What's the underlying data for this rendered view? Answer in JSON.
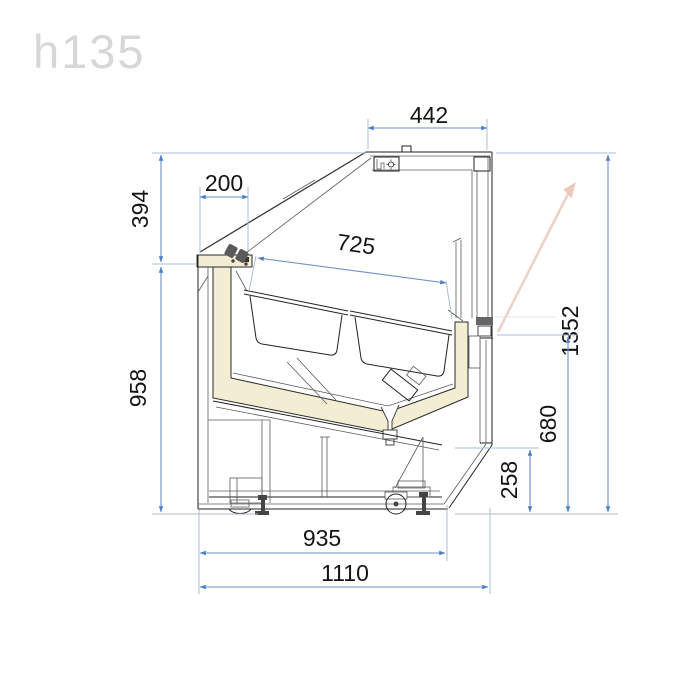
{
  "watermark": {
    "text": "h135"
  },
  "diagram": {
    "type": "technical-drawing",
    "subject": "refrigerated serve-over display counter, side cross-section",
    "units": "mm",
    "colors": {
      "dimension_line": "#6b8fc7",
      "dimension_arrow": "#4b7ec2",
      "extension_line": "#a9bcd8",
      "drawing_line": "#222222",
      "insulation_fill": "#f3edd3",
      "airflow_arrow": "#e9cabb",
      "watermark": "#d7d7d7",
      "text": "#141414"
    },
    "dimensions": [
      {
        "id": "canopy_depth",
        "value": "442",
        "orientation": "horizontal",
        "location": "top"
      },
      {
        "id": "front_overhang",
        "value": "200",
        "orientation": "horizontal",
        "location": "upper-left"
      },
      {
        "id": "glass_height",
        "value": "394",
        "orientation": "vertical",
        "location": "left-upper"
      },
      {
        "id": "body_height",
        "value": "958",
        "orientation": "vertical",
        "location": "left-lower"
      },
      {
        "id": "deck_length",
        "value": "725",
        "orientation": "slanted",
        "location": "display-well"
      },
      {
        "id": "total_height",
        "value": "1352",
        "orientation": "vertical",
        "location": "right-outer"
      },
      {
        "id": "rear_ledge_height",
        "value": "680",
        "orientation": "vertical",
        "location": "right-inner"
      },
      {
        "id": "base_height",
        "value": "258",
        "orientation": "vertical",
        "location": "right-lowest"
      },
      {
        "id": "base_depth",
        "value": "935",
        "orientation": "horizontal",
        "location": "bottom-upper"
      },
      {
        "id": "total_depth",
        "value": "1110",
        "orientation": "horizontal",
        "location": "bottom-lower"
      }
    ]
  }
}
